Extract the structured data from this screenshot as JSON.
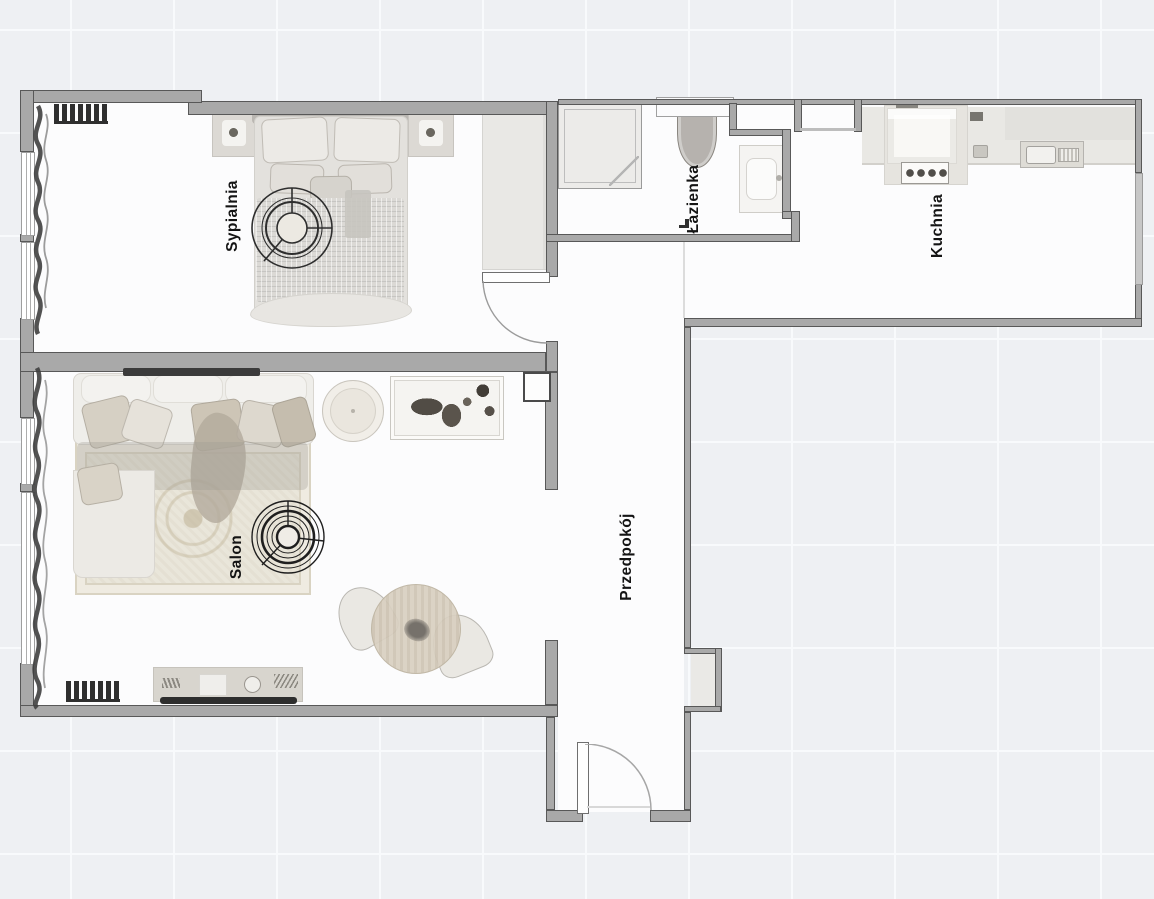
{
  "rooms": {
    "bedroom": {
      "label": "Sypialnia"
    },
    "living": {
      "label": "Salon"
    },
    "bathroom": {
      "label": "Łazienka"
    },
    "kitchen": {
      "label": "Kuchnia"
    },
    "hallway": {
      "label": "Przedpokój"
    }
  },
  "colors": {
    "wall": "#a9a9a9",
    "wall_edge": "#585858",
    "floor": "#fcfcfd",
    "exterior": "#eef0f3",
    "grid": "#f8fafc",
    "furn_light": "#efeeea",
    "furn_mid": "#dcd9d2",
    "dark": "#2e2e2e",
    "label": "#141414",
    "window": "#ffffff",
    "window_line": "#9e9e9e",
    "rug": "#e9e5d9",
    "curtain": "#3f3f3f"
  },
  "furniture": {
    "bedroom": [
      "double-bed",
      "nightstand-left",
      "nightstand-right",
      "wardrobe",
      "ceiling-light",
      "radiator",
      "curtains",
      "window"
    ],
    "living": [
      "corner-sofa",
      "area-rug",
      "round-pouf",
      "wall-art",
      "ceiling-light",
      "dining-table",
      "dining-chairs",
      "tv-console",
      "tv",
      "wall-mounted-tv",
      "radiator",
      "curtains",
      "window"
    ],
    "bathroom": [
      "shower-cabin",
      "toilet",
      "washbasin"
    ],
    "kitchen": [
      "countertop",
      "stove-oven",
      "burners",
      "kitchen-sink",
      "window"
    ],
    "hallway": [
      "entrance-door",
      "wall-niche"
    ]
  }
}
